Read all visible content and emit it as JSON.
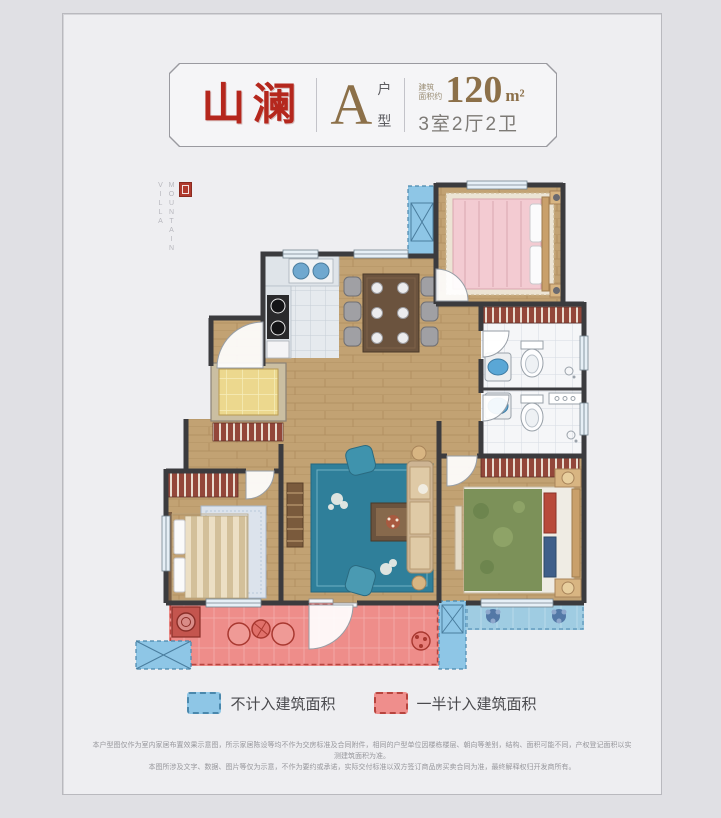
{
  "page": {
    "background": "#e0e0e4",
    "card_background": "#eeeef1"
  },
  "header": {
    "project_name": "山澜",
    "unit_letter": "A",
    "unit_type_top": "户",
    "unit_type_bottom": "型",
    "area_label_top": "建筑",
    "area_label_bottom": "面积约",
    "area_value": "120",
    "area_unit": "m²",
    "layout_spec": "3室2厅2卫",
    "brand_red": "#b5271d",
    "accent_gold": "#8c7049"
  },
  "watermark": {
    "word1": "MOUNTAIN",
    "word2": "VILLA",
    "seal_color": "#b03a2e"
  },
  "legend": {
    "items": [
      {
        "label": "不计入建筑面积",
        "swatch_color": "#8ec6e6",
        "swatch_border": "#4a88ad"
      },
      {
        "label": "一半计入建筑面积",
        "swatch_color": "#ef8e8c",
        "swatch_border": "#b8443e"
      }
    ]
  },
  "disclaimer": {
    "line1": "本户型图仅作为室内家居布置效果示意图，所示家居陈设等均不作为交房标准及合同附件，相同的户型单位因楼栋楼层、朝向等差别，结构、面积可能不同，产权登记面积以实测建筑面积为准。",
    "line2": "本图所涉及文字、数据、图片等仅为示意，不作为要约或承诺，实际交付标准以双方签订商品房买卖合同为准，最终解释权归开发商所有。"
  }
}
